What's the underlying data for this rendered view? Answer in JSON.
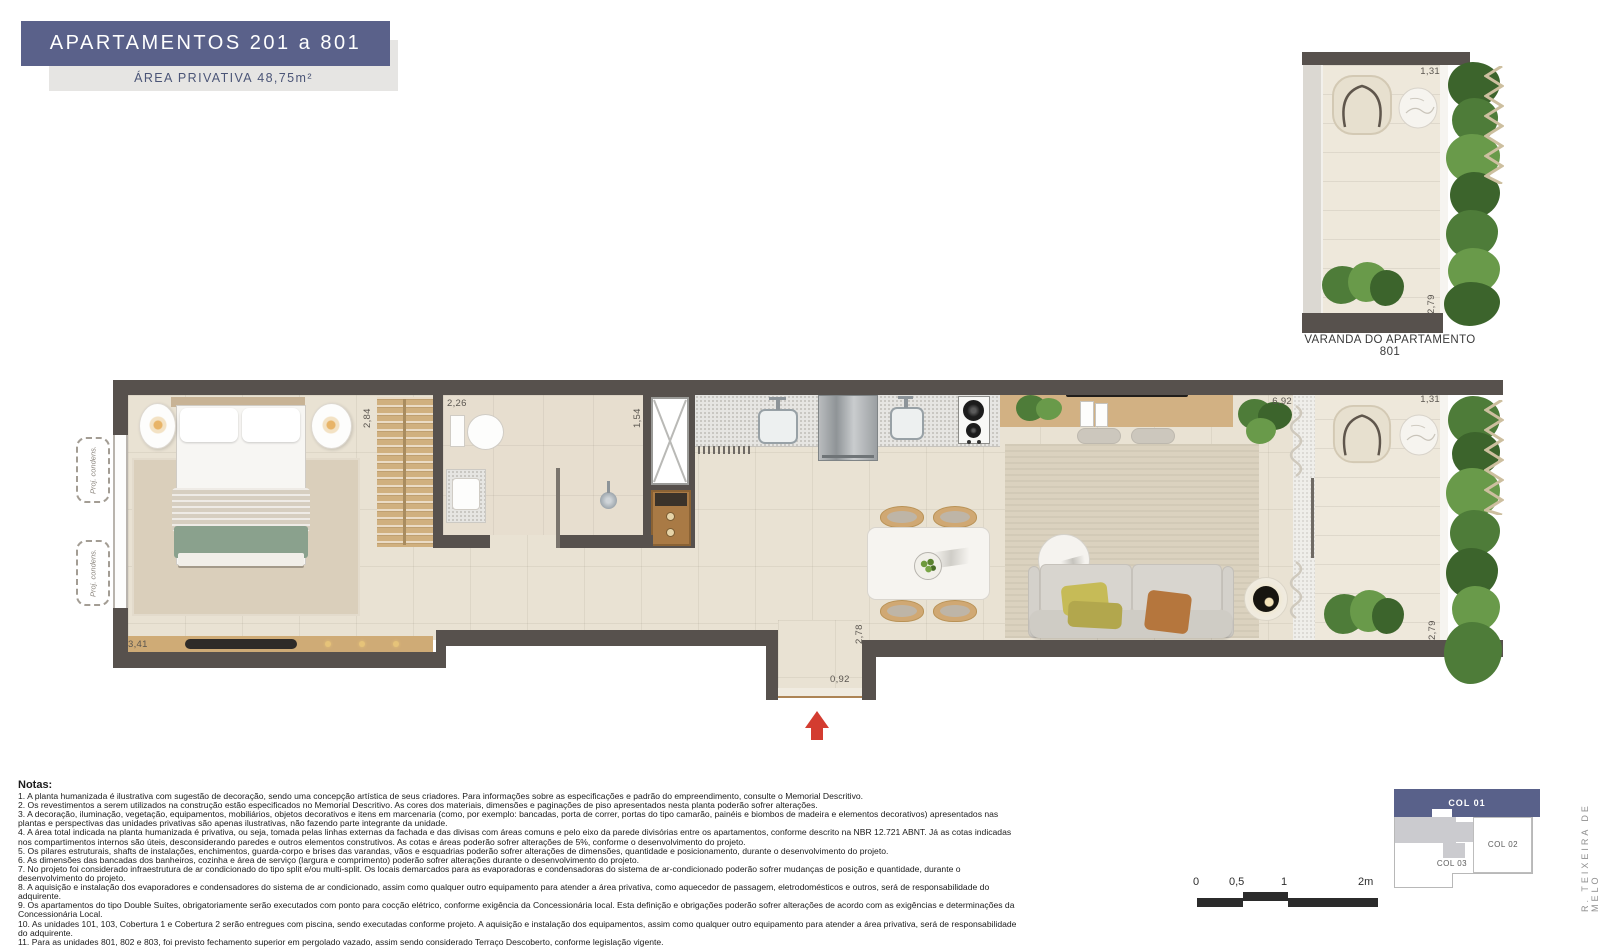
{
  "header": {
    "title": "APARTAMENTOS 201 a 801",
    "subtitle": "ÁREA PRIVATIVA 48,75m²"
  },
  "varanda": {
    "title": "VARANDA DO APARTAMENTO 801",
    "dim_top": "1,31",
    "dim_side": "2,79"
  },
  "plan": {
    "labels": {
      "proj_condens": "Proj. condens."
    },
    "dims": {
      "bedroom": "3,41",
      "closet": "2,84",
      "bath": "2,26",
      "shaft": "1,54",
      "living": "6,92",
      "balcony_top": "1,31",
      "balcony_side": "2,79",
      "hall": "2,78",
      "entry": "0,92"
    }
  },
  "notes": {
    "heading": "Notas:",
    "items": [
      "1. A planta humanizada é ilustrativa com sugestão de decoração, sendo uma concepção artística de seus criadores. Para informações sobre as especificações e padrão do empreendimento, consulte o Memorial Descritivo.",
      "2. Os revestimentos a serem utilizados na construção estão especificados no Memorial Descritivo. As cores dos materiais, dimensões e paginações de piso apresentados nesta planta poderão sofrer alterações.",
      "3. A decoração, iluminação, vegetação, equipamentos, mobiliários, objetos decorativos e itens em marcenaria (como, por exemplo: bancadas, porta de correr, portas do tipo camarão, painéis e biombos de madeira e elementos decorativos) apresentados nas plantas e perspectivas das unidades privativas são apenas ilustrativas, não fazendo parte integrante da unidade.",
      "4. A área total indicada na planta humanizada é privativa, ou seja, tomada pelas linhas externas da fachada e das divisas com áreas comuns e pelo eixo da parede divisórias entre os apartamentos, conforme descrito na NBR 12.721 ABNT. Já as cotas indicadas nos compartimentos internos são úteis, desconsiderando paredes e outros elementos construtivos. As cotas e áreas poderão sofrer alterações de 5%, conforme o desenvolvimento do projeto.",
      "5. Os pilares estruturais, shafts de instalações, enchimentos, guarda-corpo e brises das varandas, vãos e esquadrias poderão sofrer alterações de dimensões, quantidade e posicionamento, durante o desenvolvimento do projeto.",
      "6. As dimensões das bancadas dos banheiros, cozinha e área de serviço (largura e comprimento) poderão sofrer alterações durante o desenvolvimento do projeto.",
      "7. No projeto foi considerado infraestrutura de ar condicionado do tipo split e/ou multi-split. Os locais demarcados para as evaporadoras e condensadoras do sistema de ar-condicionado poderão sofrer mudanças de posição e quantidade, durante o desenvolvimento do projeto.",
      "8. A aquisição e instalação dos evaporadores e condensadores do sistema de ar condicionado, assim como qualquer outro equipamento para atender a área privativa, como aquecedor de passagem, eletrodomésticos e outros, será de responsabilidade do adquirente.",
      "9. Os apartamentos do tipo Double Suítes, obrigatoriamente serão executados com ponto para cocção elétrico, conforme exigência da Concessionária local. Esta definição e obrigações poderão sofrer alterações de acordo com as exigências e determinações da Concessionária Local.",
      "10. As unidades 101, 103, Cobertura 1 e Cobertura 2 serão entregues com piscina, sendo executadas conforme projeto. A aquisição e instalação dos equipamentos, assim como qualquer outro equipamento para atender a área privativa, será de responsabilidade do adquirente.",
      "11. Para as unidades 801, 802 e 803, foi previsto fechamento superior em pergolado vazado, assim sendo considerado Terraço Descoberto, conforme legislação vigente.",
      "12. Não serão admitidas modificações nas unidades privativas, exceto aquelas eventualmente oferecidas pela incorporadora e sendo solicitadas formalmente dentro do prazo estabelecido."
    ]
  },
  "scale": {
    "t0": "0",
    "t05": "0,5",
    "t1": "1",
    "t2": "2m"
  },
  "keyplan": {
    "col01": "COL 01",
    "col02": "COL 02",
    "col03": "COL 03"
  },
  "street": "R. TEIXEIRA DE MELO",
  "colors": {
    "title_bar": "#5a618a",
    "keyplan_col01": "#59618a",
    "wall": "#57514d",
    "arrow_red": "#d33c30"
  }
}
